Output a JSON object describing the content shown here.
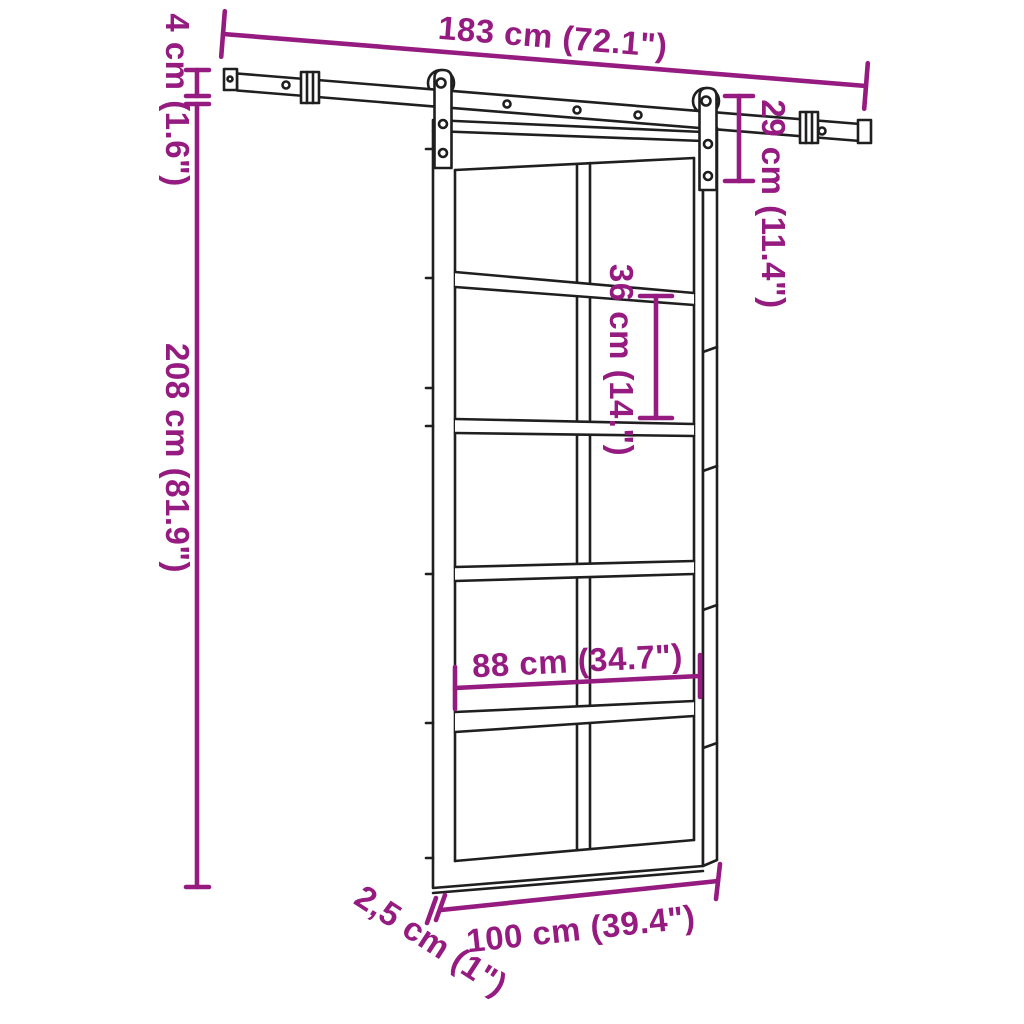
{
  "diagram": {
    "kind": "sliding-barn-door-dimension-diagram",
    "colors": {
      "dimension_accent": "#951b81",
      "line_art": "#1f1f1f",
      "background": "#ffffff"
    },
    "dims": {
      "rail_length": "183 cm (72.1\")",
      "rail_height": "4 cm (1.6\")",
      "door_height": "208 cm (81.9\")",
      "hanger_height": "29 cm (11.4\")",
      "panel_height": "36 cm (14.\")",
      "inner_width": "88 cm (34.7\")",
      "door_width": "100 cm (39.4\")",
      "door_thickness": "2,5 cm (1\")"
    }
  }
}
